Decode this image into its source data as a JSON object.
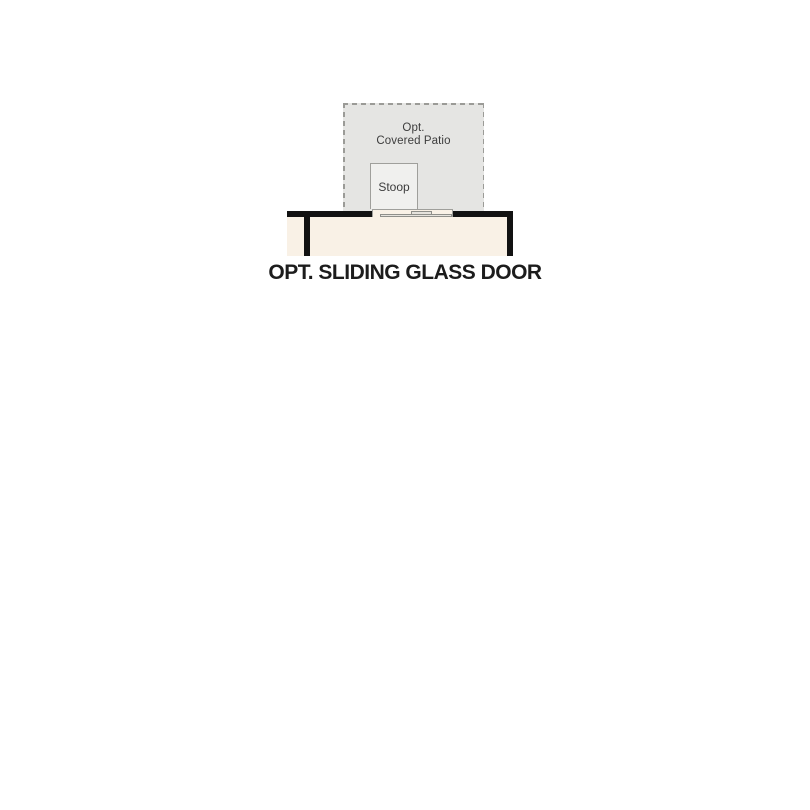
{
  "plan": {
    "title": "OPT. SLIDING GLASS DOOR",
    "patio_label_line1": "Opt.",
    "patio_label_line2": "Covered Patio",
    "stoop_label": "Stoop"
  },
  "colors": {
    "background": "#ffffff",
    "patio_fill": "#e5e5e3",
    "dash_line": "#9b9b97",
    "stoop_fill": "#f0f0ee",
    "stoop_border": "#9f9f9b",
    "floor_fill": "#f9f1e6",
    "wall": "#121212",
    "door_line": "#8f8f8a",
    "door_fill": "#e6e3dd",
    "title_text": "#1c1c1c",
    "label_text": "#3d3d3d"
  }
}
